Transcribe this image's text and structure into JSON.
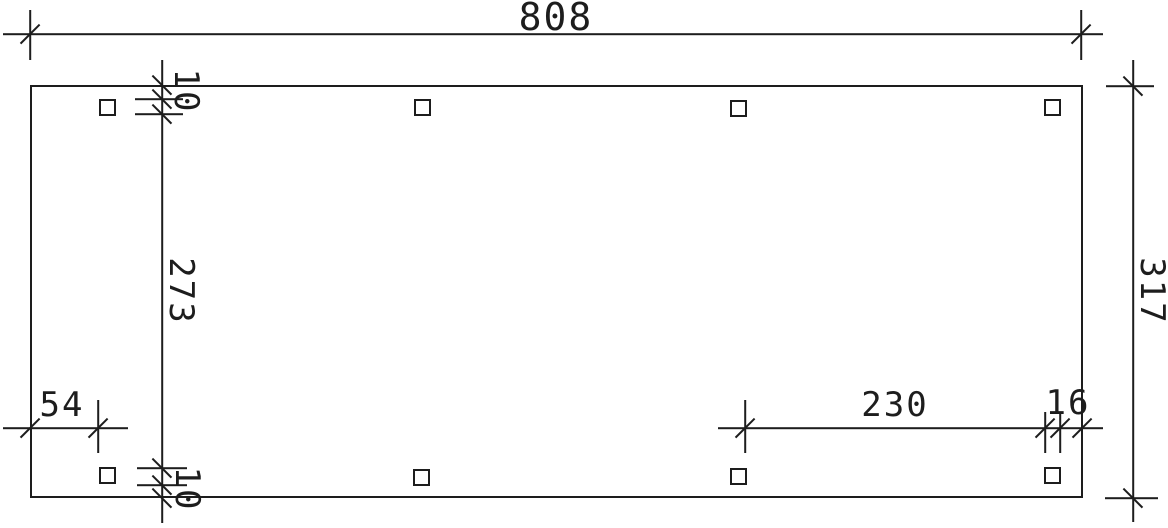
{
  "drawing": {
    "kind": "dimensioned plan drawing",
    "colors": {
      "line": "#1d1d1d",
      "background": "#ffffff"
    }
  },
  "dimensions": {
    "total_width": "808",
    "total_depth": "317",
    "clear_inner_depth": "273",
    "edge_to_post_top": "10",
    "edge_to_post_bottom": "10",
    "left_edge_to_post": "54",
    "post_clear_spacing": "230",
    "post_to_right_edge": "16"
  }
}
